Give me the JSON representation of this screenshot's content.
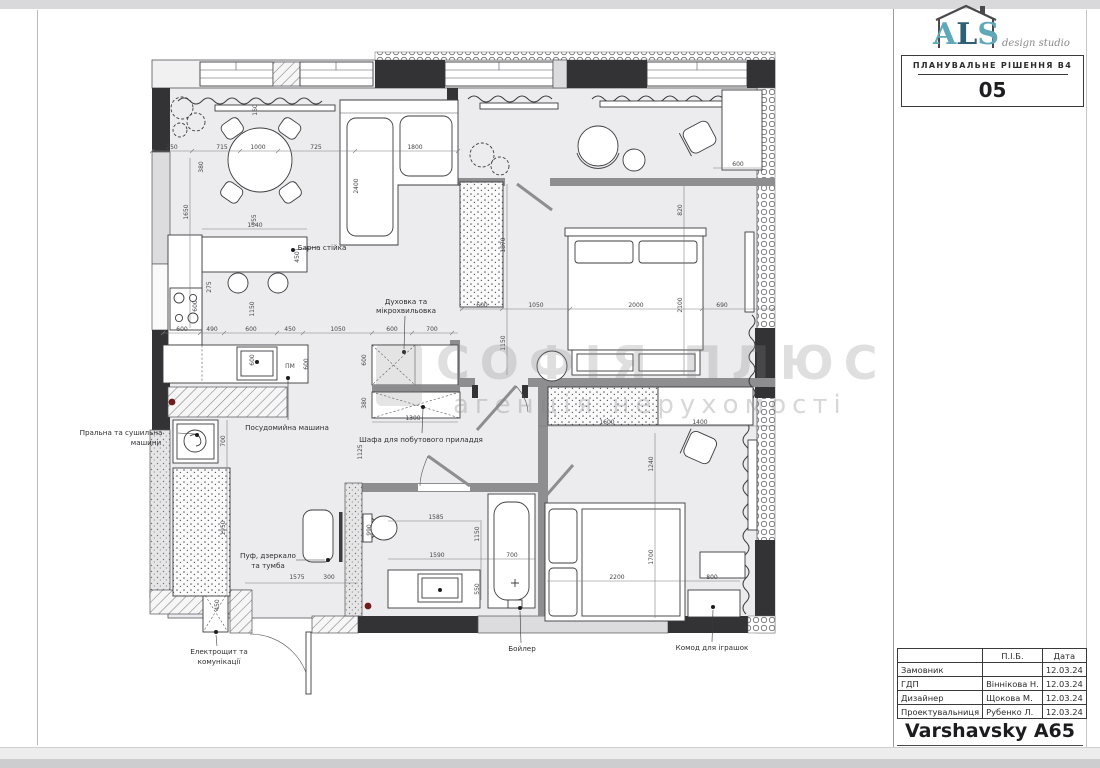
{
  "title_block": {
    "logo_a": "A",
    "logo_l": "L",
    "logo_s": "S",
    "logo_sub": "design studio",
    "plan_label": "ПЛАНУВАЛЬНЕ РІШЕННЯ В4",
    "sheet_number": "05",
    "table": {
      "col_person": "П.І.Б.",
      "col_date": "Дата",
      "rows": [
        {
          "role": "Замовник",
          "name": "",
          "date": "12.03.24"
        },
        {
          "role": "ГДП",
          "name": "Віннікова Н.",
          "date": "12.03.24"
        },
        {
          "role": "Дизайнер",
          "name": "Щокова М.",
          "date": "12.03.24"
        },
        {
          "role": "Проектувальниця",
          "name": "Рубенко Л.",
          "date": "12.03.24"
        }
      ]
    },
    "project_name": "Varshavsky A65"
  },
  "watermark": {
    "line1": "СОФІЯ ПЛЮС",
    "line2": "агенція нерухомості"
  },
  "colors": {
    "accent_teal": "#5fa8ba",
    "accent_navy": "#2e5f77",
    "wall_dark": "#333335",
    "wall_gray": "#8e8e91"
  },
  "plan": {
    "labels": {
      "bar_counter": "Барна стійка",
      "pm": "ПМ",
      "dishwasher": "Посудомийна машина",
      "oven_l1": "Духовка та",
      "oven_l2": "мікрохвильовка",
      "household": "Шафа для побутового приладдя",
      "washer_l1": "Пральна та сушильна",
      "washer_l2": "машини",
      "pouf_l1": "Пуф, дзеркало",
      "pouf_l2": "та тумба",
      "electro_l1": "Електрощит та",
      "electro_l2": "комунікації",
      "boiler": "Бойлер",
      "toys": "Комод для іграшок"
    },
    "dims": {
      "top": [
        "250",
        "715",
        "1000",
        "725",
        "1800"
      ],
      "living_v": [
        "160",
        "380",
        "1650",
        "755",
        "2400"
      ],
      "bar": [
        "1540",
        "450",
        "275",
        "600",
        "1150"
      ],
      "kitchen_row": [
        "600",
        "490",
        "600",
        "450",
        "1050",
        "600",
        "700"
      ],
      "kitchen_misc": [
        "600",
        "600",
        "380",
        "1300",
        "1125",
        "600"
      ],
      "bedroom_row": [
        "600",
        "1050",
        "2000",
        "690"
      ],
      "bedroom_v": [
        "820",
        "2100",
        "1870",
        "1150"
      ],
      "loggia": [
        "600"
      ],
      "kids": [
        "1600",
        "1400",
        "1240",
        "2200",
        "1700",
        "800"
      ],
      "bath": [
        "1585",
        "1590",
        "700",
        "550",
        "990",
        "1150"
      ],
      "hall": [
        "700",
        "1950",
        "1575",
        "300",
        "450"
      ]
    }
  }
}
